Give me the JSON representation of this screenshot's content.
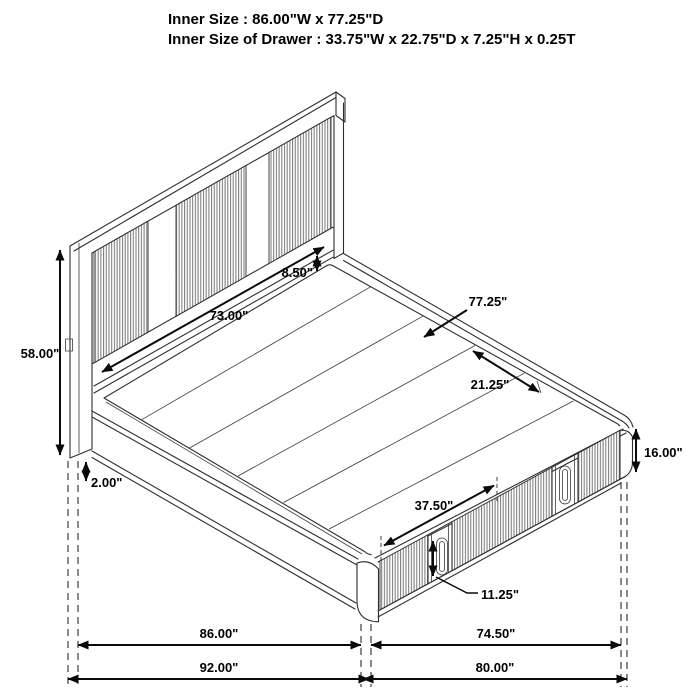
{
  "title": "Bed dimension diagram",
  "header": {
    "line1": "Inner Size : 86.00\"W x 77.25\"D",
    "line2": "Inner Size of Drawer : 33.75\"W x 22.75\"D x 7.25\"H x 0.25T"
  },
  "dimensions": {
    "headboard_height": "58.00\"",
    "headboard_panel_width": "73.00\"",
    "headboard_platform_gap": "8.50\"",
    "platform_depth": "77.25\"",
    "rail_end_segment": "21.25\"",
    "drawer_front_width": "37.50\"",
    "drawer_front_height": "11.25\"",
    "frame_height": "16.00\"",
    "floor_clearance": "2.00\"",
    "inner_width": "86.00\"",
    "outer_width": "92.00\"",
    "drawer_section_span": "74.50\"",
    "footboard_span": "80.00\""
  },
  "colors": {
    "line": "#2e2e2e",
    "dimension": "#0a0a0a",
    "flute": "#777777",
    "background": "#ffffff"
  }
}
